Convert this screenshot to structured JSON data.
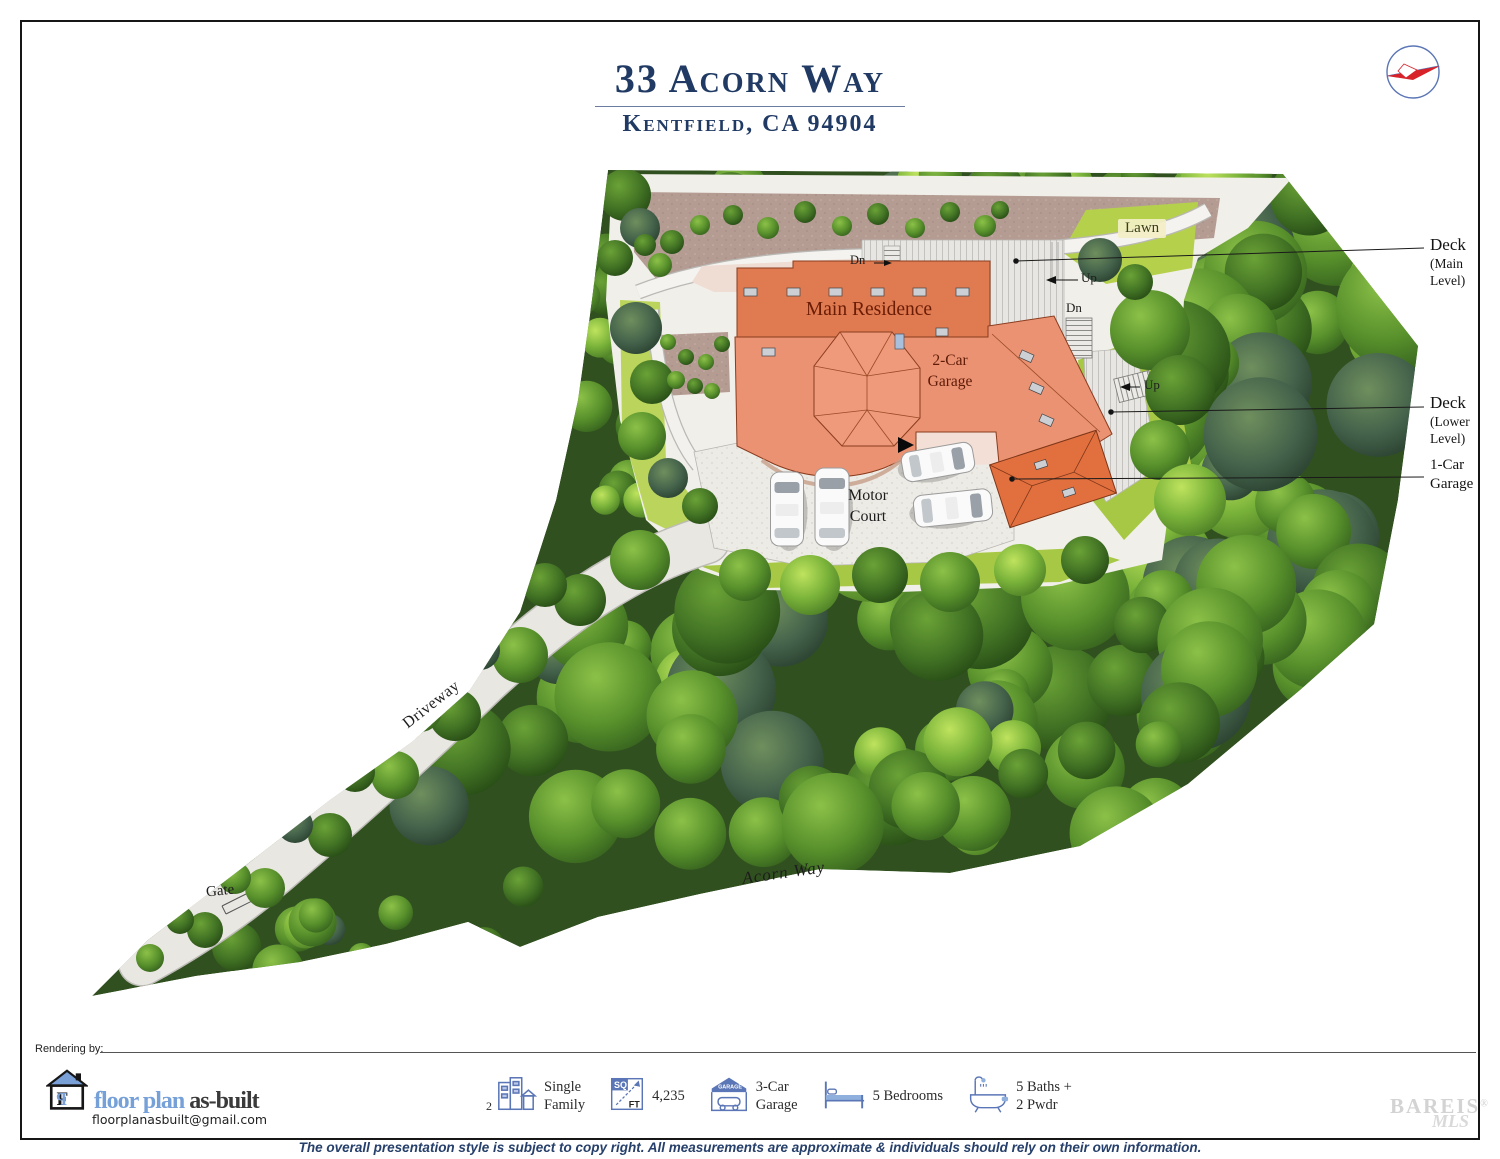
{
  "title": {
    "address": "33 Acorn Way",
    "city": "Kentfield, CA 94904"
  },
  "compass": {
    "icon": "compass-icon"
  },
  "plan": {
    "labels": {
      "main_residence": "Main Residence",
      "garage2_l1": "2-Car",
      "garage2_l2": "Garage",
      "motor_l1": "Motor",
      "motor_l2": "Court",
      "lawn": "Lawn",
      "driveway": "Driveway",
      "gate": "Gate",
      "street": "Acorn Way",
      "dn_top": "Dn",
      "up_main": "Up",
      "dn_main": "Dn",
      "up_lower": "Up"
    },
    "callouts": {
      "deck_main": {
        "l1": "Deck",
        "l2": "(Main",
        "l3": "Level)"
      },
      "deck_lower": {
        "l1": "Deck",
        "l2": "(Lower",
        "l3": "Level)"
      },
      "garage1": {
        "l1": "1-Car",
        "l2": "Garage"
      }
    }
  },
  "colors": {
    "title_navy": "#203a64",
    "building_body": "#eb9273",
    "building_wing": "#df7a51",
    "roof_orange": "#e2703f",
    "tree_green": "#5a8f2b",
    "brand_blue": "#76a0d8",
    "disclaimer_navy": "#26406b",
    "compass_red": "#d8222a"
  },
  "footer": {
    "rendering_by": "Rendering by:",
    "logo": {
      "icon": "house-logo-icon",
      "name_blue": "floor plan",
      "name_dark": "as-built",
      "email": "floorplanasbuilt@gmail.com"
    },
    "stats": [
      {
        "icon": "buildings-icon",
        "prefix": "2",
        "l1": "Single",
        "l2": "Family"
      },
      {
        "icon": "sqft-icon",
        "sq": "SQ",
        "ft": "FT",
        "l1": "4,235",
        "l2": ""
      },
      {
        "icon": "garage-icon",
        "text": "GARAGE",
        "l1": "3-Car",
        "l2": "Garage"
      },
      {
        "icon": "bed-icon",
        "l1": "5 Bedrooms",
        "l2": ""
      },
      {
        "icon": "bath-icon",
        "l1": "5 Baths +",
        "l2": "2 Pwdr"
      }
    ],
    "watermark": {
      "l1": "BAREIS",
      "reg": "®",
      "l2": "MLS"
    },
    "disclaimer": "The overall presentation style is subject to copy right. All measurements are approximate & individuals should rely on their own information."
  }
}
